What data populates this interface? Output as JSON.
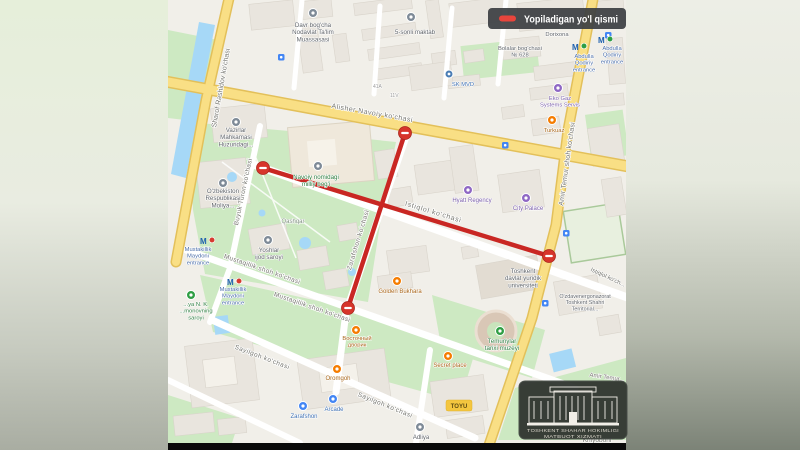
{
  "legend": {
    "label": "Yopiladigan yo'l qismi",
    "swatch_color": "#E8453C",
    "background": "#3C4043"
  },
  "watermark": {
    "org_line1": "TOSHKENT SHAHAR HOKIMLIGI",
    "org_line2": "MATBUOT XIZMATI"
  },
  "colors": {
    "closed_road_red": "#C92723",
    "major_road_yellow": "#F9DF85",
    "park_green": "#CDE9C2",
    "water_blue": "#A6D8F7",
    "map_base": "#F1EFE9"
  },
  "streets": {
    "sharof_rashidov": "Sharof Rashidov ko'chasi",
    "alisher_navoiy": "Alisher Navoiy ko'chasi",
    "buyuk_turon": "Buyuk Turon ko'chasi",
    "istiqlol": "Istiqlol ko'chasi",
    "istiqlol_short": "Istiqlol ko'ch...",
    "zarafshon": "Zarafshon ko'chasi",
    "mustaqillik": "Mustaqillik shoh ko'chasi",
    "sayilgoh": "Sayilgoh ko'chasi",
    "amir_temur": "Amir Temur shoh ko'chasi",
    "amir_temur_short": "Amir Temur...",
    "khiyoboni": "Khiyoboni"
  },
  "places": {
    "davr_bogcha": "Davr bog'cha\nNodavlat Ta'lim\nMuassasasi",
    "maktab5": "5-sonli maktab",
    "dorixona": "Dorixona",
    "bolalar_bogchasi": "Bolalar bog'chasi\n№ 628",
    "sk_mvd": "SK MVD",
    "eko_gaz": "Eko Gaz\nSystems Servis",
    "turkuaz": "Turkuaz",
    "abdulla_qodiriy_entrance": "Abdulla\nQodiriy\nentrance",
    "vazirlar": "Vazirlar\nMahkamasi\nHuzuridagi...",
    "moliya": "O'zbekiston\nRespublikasi\nMoliya...",
    "navoiy_park": "Navoiy nomidagi\nmilliy bog'i",
    "qashqar": "Qashqar",
    "yoshlar": "Yoshlar\nijod saroyi",
    "mustaqillik_entrance": "Mustakillik\nMaydoni\nentrance",
    "nk_saroyi": "...ya N. K.\n...monovning\nsaroyi",
    "hyatt": "Hyatt Regency",
    "city_palace": "City Palace",
    "yuridik": "Toshkent\ndavlat yuridik\nuniversiteti",
    "ozdavenergo": "O'zdavenergonazorat\nToshkent Shahri\nTerritorial...",
    "temuriylar": "Temuriylar\ntarixi muzeyi",
    "secret_place": "Secret place",
    "golden_bukhara": "Golden Bukhara",
    "vostochniy": "Восточный\nдворик",
    "oromgoh": "Oromgoh",
    "zarafshon_hall": "Zarafshon",
    "arcade": "Arcade",
    "adliya": "Adliya",
    "toyu": "TOYU",
    "house_41a": "41A",
    "house_11v": "11V"
  }
}
